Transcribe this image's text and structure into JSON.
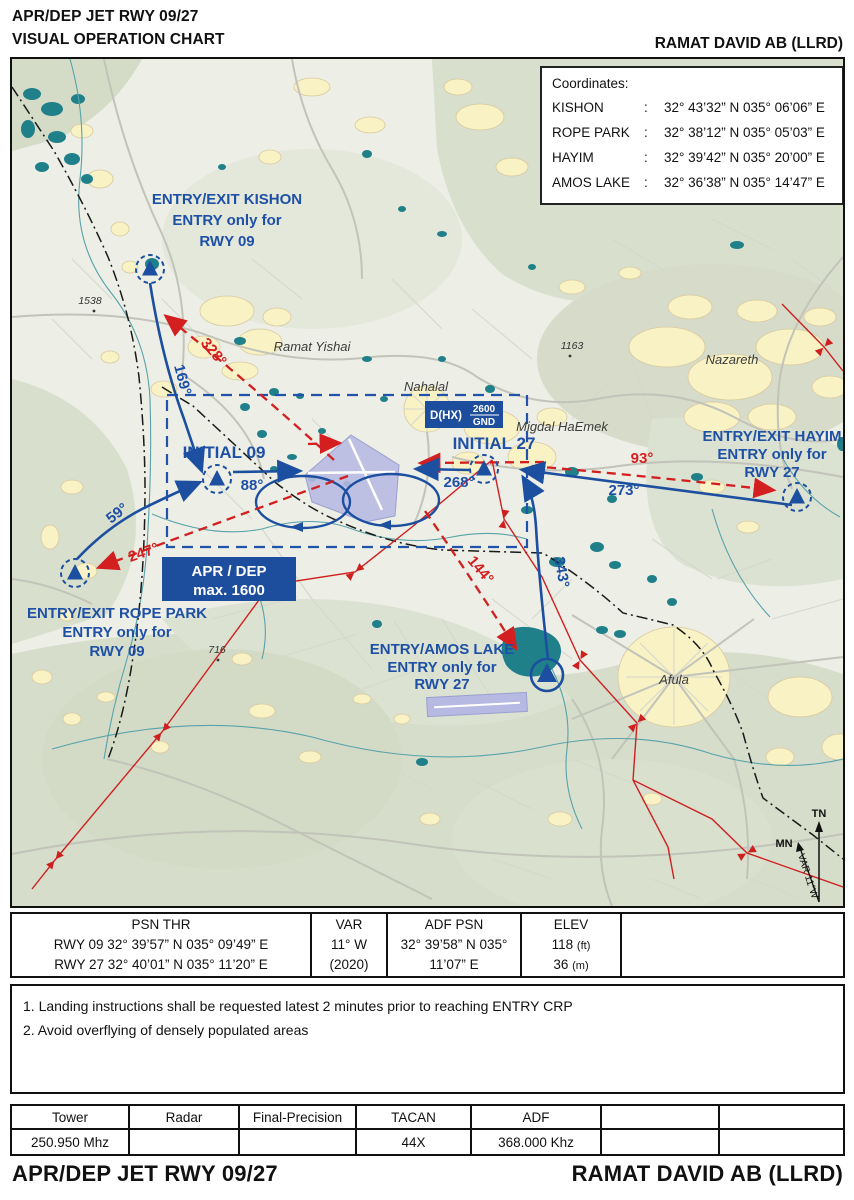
{
  "header": {
    "title_line1": "APR/DEP JET RWY 09/27",
    "title_line2": "VISUAL OPERATION CHART",
    "airport": "RAMAT DAVID AB (LLRD)"
  },
  "coordinates_box": {
    "title": "Coordinates:",
    "rows": [
      {
        "name": "KISHON",
        "sep": ":",
        "value": "32° 43’32” N 035° 06’06” E"
      },
      {
        "name": "ROPE PARK",
        "sep": ":",
        "value": "32° 38’12” N 035° 05’03” E"
      },
      {
        "name": "HAYIM",
        "sep": ":",
        "value": "32° 39’42” N 035° 20’00” E"
      },
      {
        "name": "AMOS LAKE",
        "sep": ":",
        "value": "32° 36’38” N 035° 14’47” E"
      }
    ]
  },
  "map": {
    "entry_labels": {
      "kishon": {
        "l1": "ENTRY/EXIT KISHON",
        "l2": "ENTRY only for",
        "l3": "RWY 09"
      },
      "rope_park": {
        "l1": "ENTRY/EXIT ROPE PARK",
        "l2": "ENTRY only for",
        "l3": "RWY 09"
      },
      "hayim": {
        "l1": "ENTRY/EXIT HAYIM",
        "l2": "ENTRY only for",
        "l3": "RWY 27"
      },
      "amos_lake": {
        "l1": "ENTRY/AMOS LAKE",
        "l2": "ENTRY only for",
        "l3": "RWY 27"
      }
    },
    "initial_09": "INITIAL 09",
    "initial_27": "INITIAL 27",
    "bearings": {
      "b169": "169°",
      "b328": "328°",
      "b59": "59°",
      "b247": "247°",
      "b88": "88°",
      "b268": "268°",
      "b93": "93°",
      "b273": "273°",
      "b144": "144°",
      "b343": "343°"
    },
    "apr_dep_box": {
      "l1": "APR / DEP",
      "l2": "max. 1600"
    },
    "danger_box": {
      "prefix": "D(HX)",
      "upper": "2600",
      "lower": "GND"
    },
    "places": {
      "ramat_yishai": "Ramat Yishai",
      "nahalal": "Nahalal",
      "migdal_haemek": "Migdal HaEmek",
      "nazareth": "Nazareth",
      "afula": "Afula"
    },
    "spots": {
      "s1538": "1538",
      "s716": "716",
      "s1163": "1163"
    },
    "compass": {
      "tn": "TN",
      "mn": "MN",
      "var": "VAR 11°W"
    }
  },
  "psn_table": {
    "col1": {
      "header": "PSN THR",
      "row1": "RWY 09 32° 39’57” N 035° 09’49” E",
      "row2": "RWY 27 32° 40’01” N 035° 11’20” E"
    },
    "col2": {
      "header": "VAR",
      "row1": "11° W",
      "row2": "(2020)"
    },
    "col3": {
      "header": "ADF PSN",
      "row1": "32° 39’58” N 035°",
      "row2": "11’07” E"
    },
    "col4": {
      "header": "ELEV",
      "row1": "118",
      "row1_unit": "(ft)",
      "row2": "36",
      "row2_unit": "(m)"
    }
  },
  "notes": {
    "n1": "1. Landing instructions shall be requested latest 2 minutes prior to reaching ENTRY CRP",
    "n2": "2. Avoid overflying of densely populated areas"
  },
  "freq_table": {
    "headers": [
      "Tower",
      "Radar",
      "Final-Precision",
      "TACAN",
      "ADF",
      "",
      ""
    ],
    "values": [
      "250.950 Mhz",
      "",
      "",
      "44X",
      "368.000 Khz",
      "",
      ""
    ]
  },
  "footer": {
    "left": "APR/DEP JET RWY 09/27",
    "right": "RAMAT DAVID AB (LLRD)"
  },
  "colors": {
    "route_blue": "#1c4f9f",
    "exit_red": "#d31f1f",
    "box_blue": "#1d4e9e",
    "water_teal": "#20808a",
    "settlement_yellow": "#f9f2c5",
    "runway_fill": "#b6b9e2"
  }
}
